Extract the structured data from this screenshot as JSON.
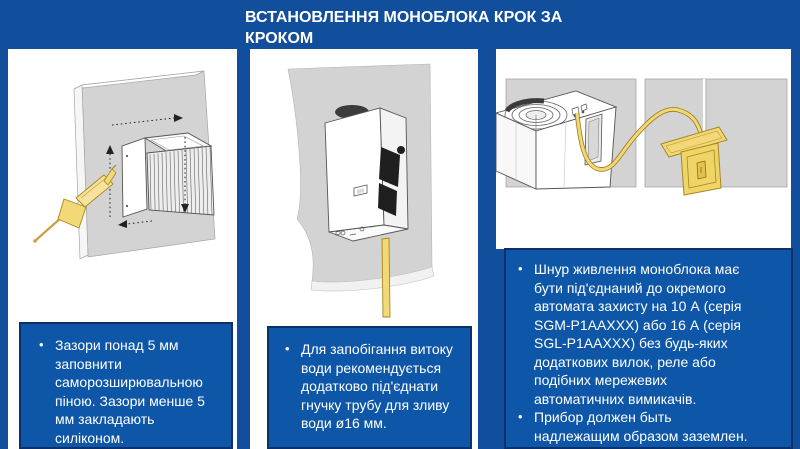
{
  "title": "ВСТАНОВЛЕННЯ МОНОБЛОКА КРОК ЗА КРОКОМ",
  "bullet_char": "•",
  "steps": {
    "step1": {
      "illustration": "unit-in-wall-hole-with-sealant-gun",
      "bullet1": "Зазори понад 5 мм заповнити саморозширювальною піною. Зазори менше 5 мм закладають силіконом."
    },
    "step2": {
      "illustration": "monoblock-with-flexible-drain-tube",
      "bullet1": "Для запобігання витоку води рекомендується додатково під'єднати гнучку трубу для зливу води ø16 мм."
    },
    "step3": {
      "illustration": "power-cord-to-circuit-breaker-box",
      "bullet1": "Шнур живлення моноблока має бути під'єднаний до окремого автомата захисту на 10 А (серія SGM-P1AAXXX) або 16 А (серія SGL-P1AAXXX) без будь-яких додаткових вилок, реле або подібних мережевих автоматичних вимикачів.",
      "bullet2": "Прибор должен быть надлежащим образом заземлен."
    }
  },
  "colors": {
    "background": "#114F9C",
    "panel": "#FFFFFF",
    "note_box_fill": "#0E57A8",
    "note_box_border": "#0B3168",
    "text": "#FFFFFF",
    "illustration_gray": "#D3D3D3",
    "accent_yellow": "#F2D877"
  }
}
